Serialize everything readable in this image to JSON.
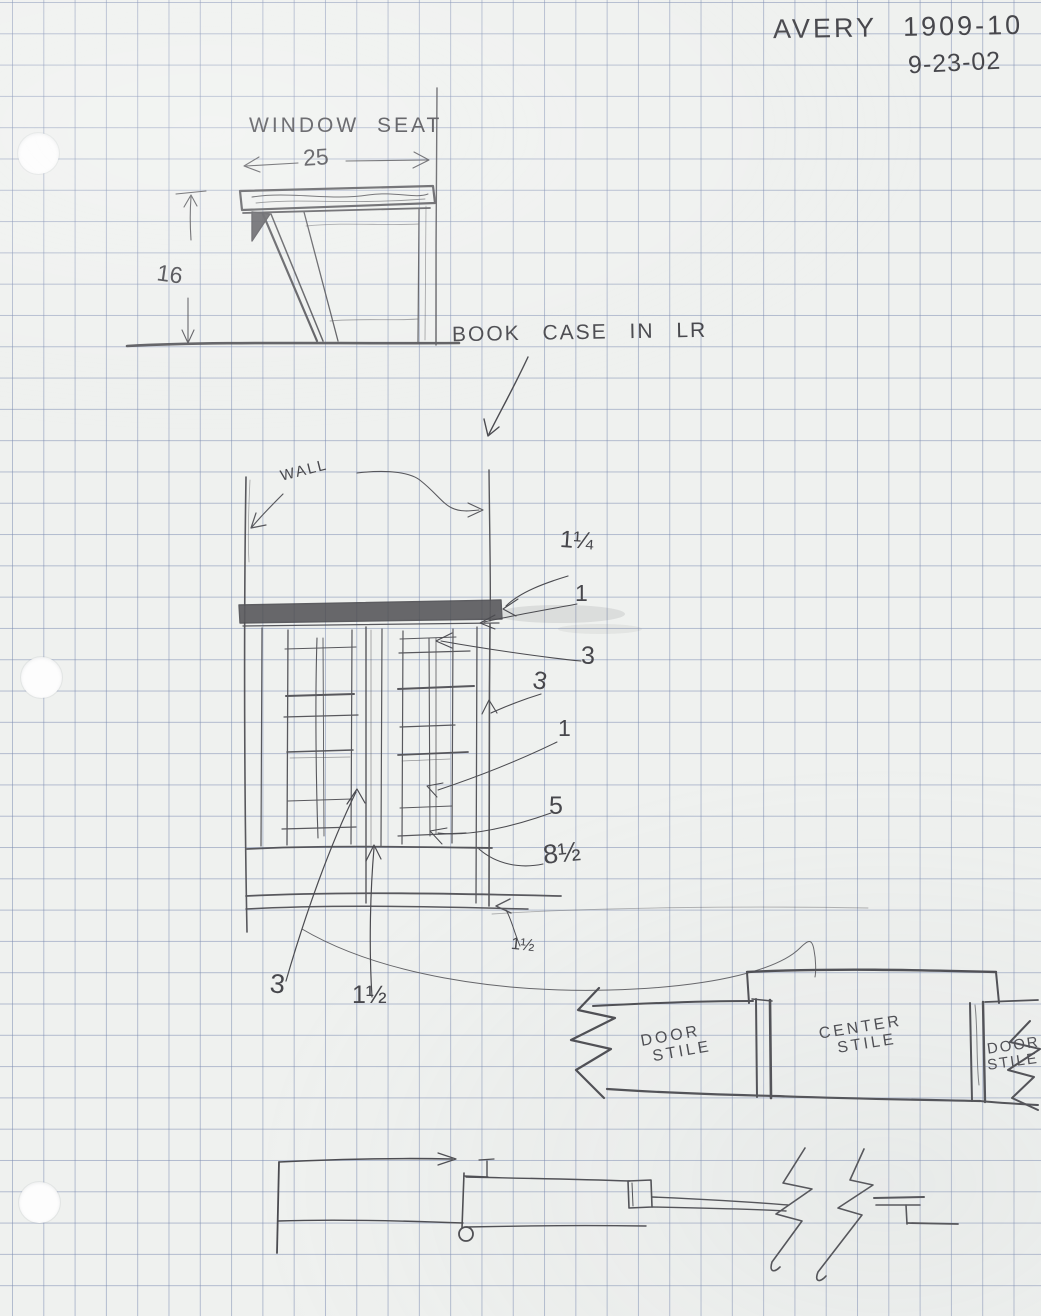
{
  "header": {
    "title": "AVERY 1909-10",
    "date": "9-23-02"
  },
  "window_seat": {
    "label": "WINDOW SEAT",
    "width_in": "25",
    "height_in": "16"
  },
  "bookcase": {
    "label": "BOOK CASE IN LR",
    "wall_label": "WALL",
    "dims": {
      "top_thickness": "1¼",
      "top_reveal": "1",
      "top_rail": "3",
      "side_stile": "3",
      "door_stile": "1",
      "bottom_rail": "5",
      "base_height": "8½",
      "base_reveal": "1½",
      "bottom_left": "3",
      "center_bottom": "1½"
    }
  },
  "stile_detail": {
    "left": {
      "line1": "DOOR",
      "line2": "STILE"
    },
    "center": {
      "line1": "CENTER",
      "line2": "STILE"
    },
    "right": {
      "line1": "DOOR",
      "line2": "STILE"
    }
  },
  "colors": {
    "paper": "#eff1ef",
    "grid": "#8b99bc",
    "pencil": "#47474c"
  }
}
